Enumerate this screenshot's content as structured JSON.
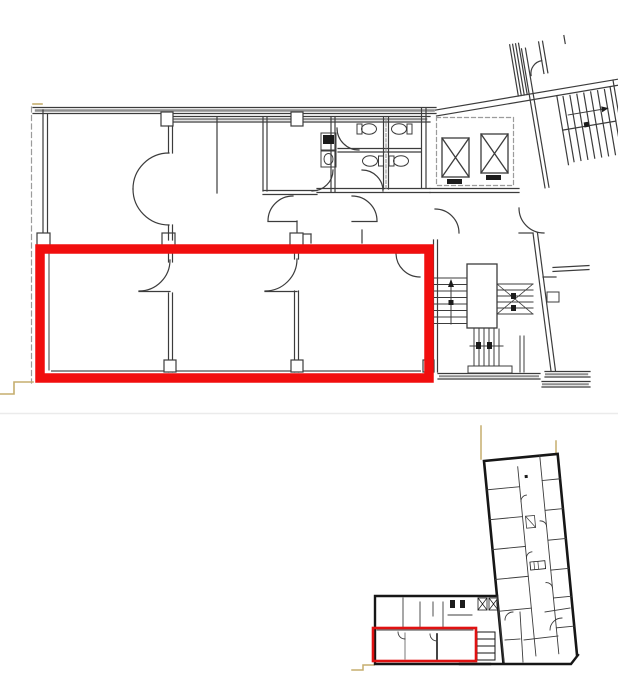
{
  "page": {
    "width": 618,
    "height": 688,
    "background": "#ffffff"
  },
  "colors": {
    "wall": "#3c3c3c",
    "wall_dark": "#161616",
    "wall_medium": "#6a6a6a",
    "hatch_dot": "#8f8f8f",
    "dashed_line": "#9b9b9b",
    "fixture_dark": "#1c1c1c",
    "white": "#ffffff",
    "highlight_red": "#f10e0e",
    "overview_red": "#e01212",
    "crop_mark_tan": "#c5ad6e",
    "divider_gray": "#ebebeb"
  },
  "main_plan": {
    "name": "detail-floor-plan",
    "highlight": {
      "x": 40,
      "y": 249,
      "width": 389,
      "height": 129,
      "stroke_width": 9.5
    }
  },
  "overview_plan": {
    "name": "building-overview-plan",
    "highlight": {
      "x": 373,
      "y": 628,
      "width": 103,
      "height": 33,
      "stroke_width": 2.6
    }
  }
}
